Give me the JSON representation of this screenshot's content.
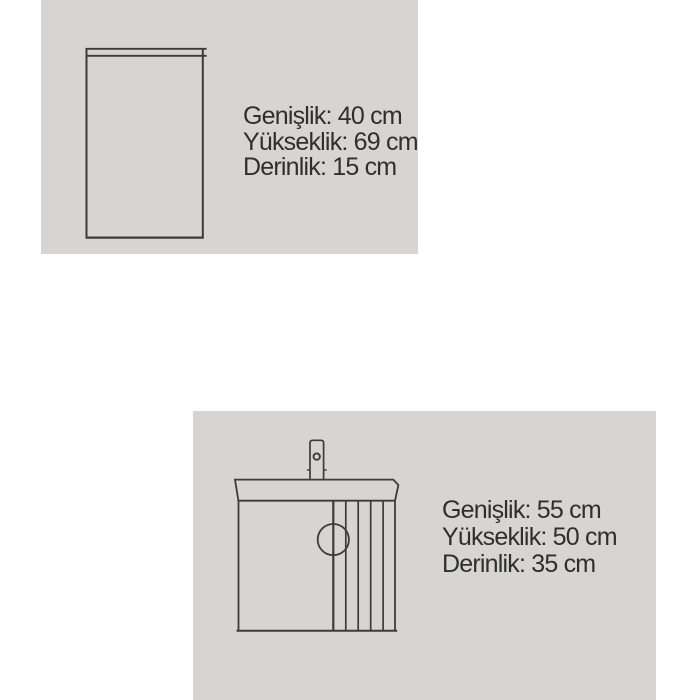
{
  "colors": {
    "page_background": "#ffffff",
    "panel_background": "#d6d5d1",
    "diagram_line": "#3c3c3c",
    "text": "#2f2f2f"
  },
  "products": [
    {
      "diagram": "tall-side-cabinet-front-outline",
      "dimensions": [
        {
          "label": "Genişlik",
          "value": "40 cm",
          "text": "Genişlik: 40 cm"
        },
        {
          "label": "Yükseklik",
          "value": "69 cm",
          "text": "Yükseklik: 69 cm"
        },
        {
          "label": "Derinlik",
          "value": "15 cm",
          "text": "Derinlik: 15 cm"
        }
      ]
    },
    {
      "diagram": "washbasin-vanity-cabinet-outline-with-faucet",
      "dimensions": [
        {
          "label": "Genişlik",
          "value": "55 cm",
          "text": "Genişlik: 55 cm"
        },
        {
          "label": "Yükseklik",
          "value": "50 cm",
          "text": "Yükseklik: 50 cm"
        },
        {
          "label": "Derinlik",
          "value": "35 cm",
          "text": "Derinlik: 35 cm"
        }
      ]
    }
  ]
}
